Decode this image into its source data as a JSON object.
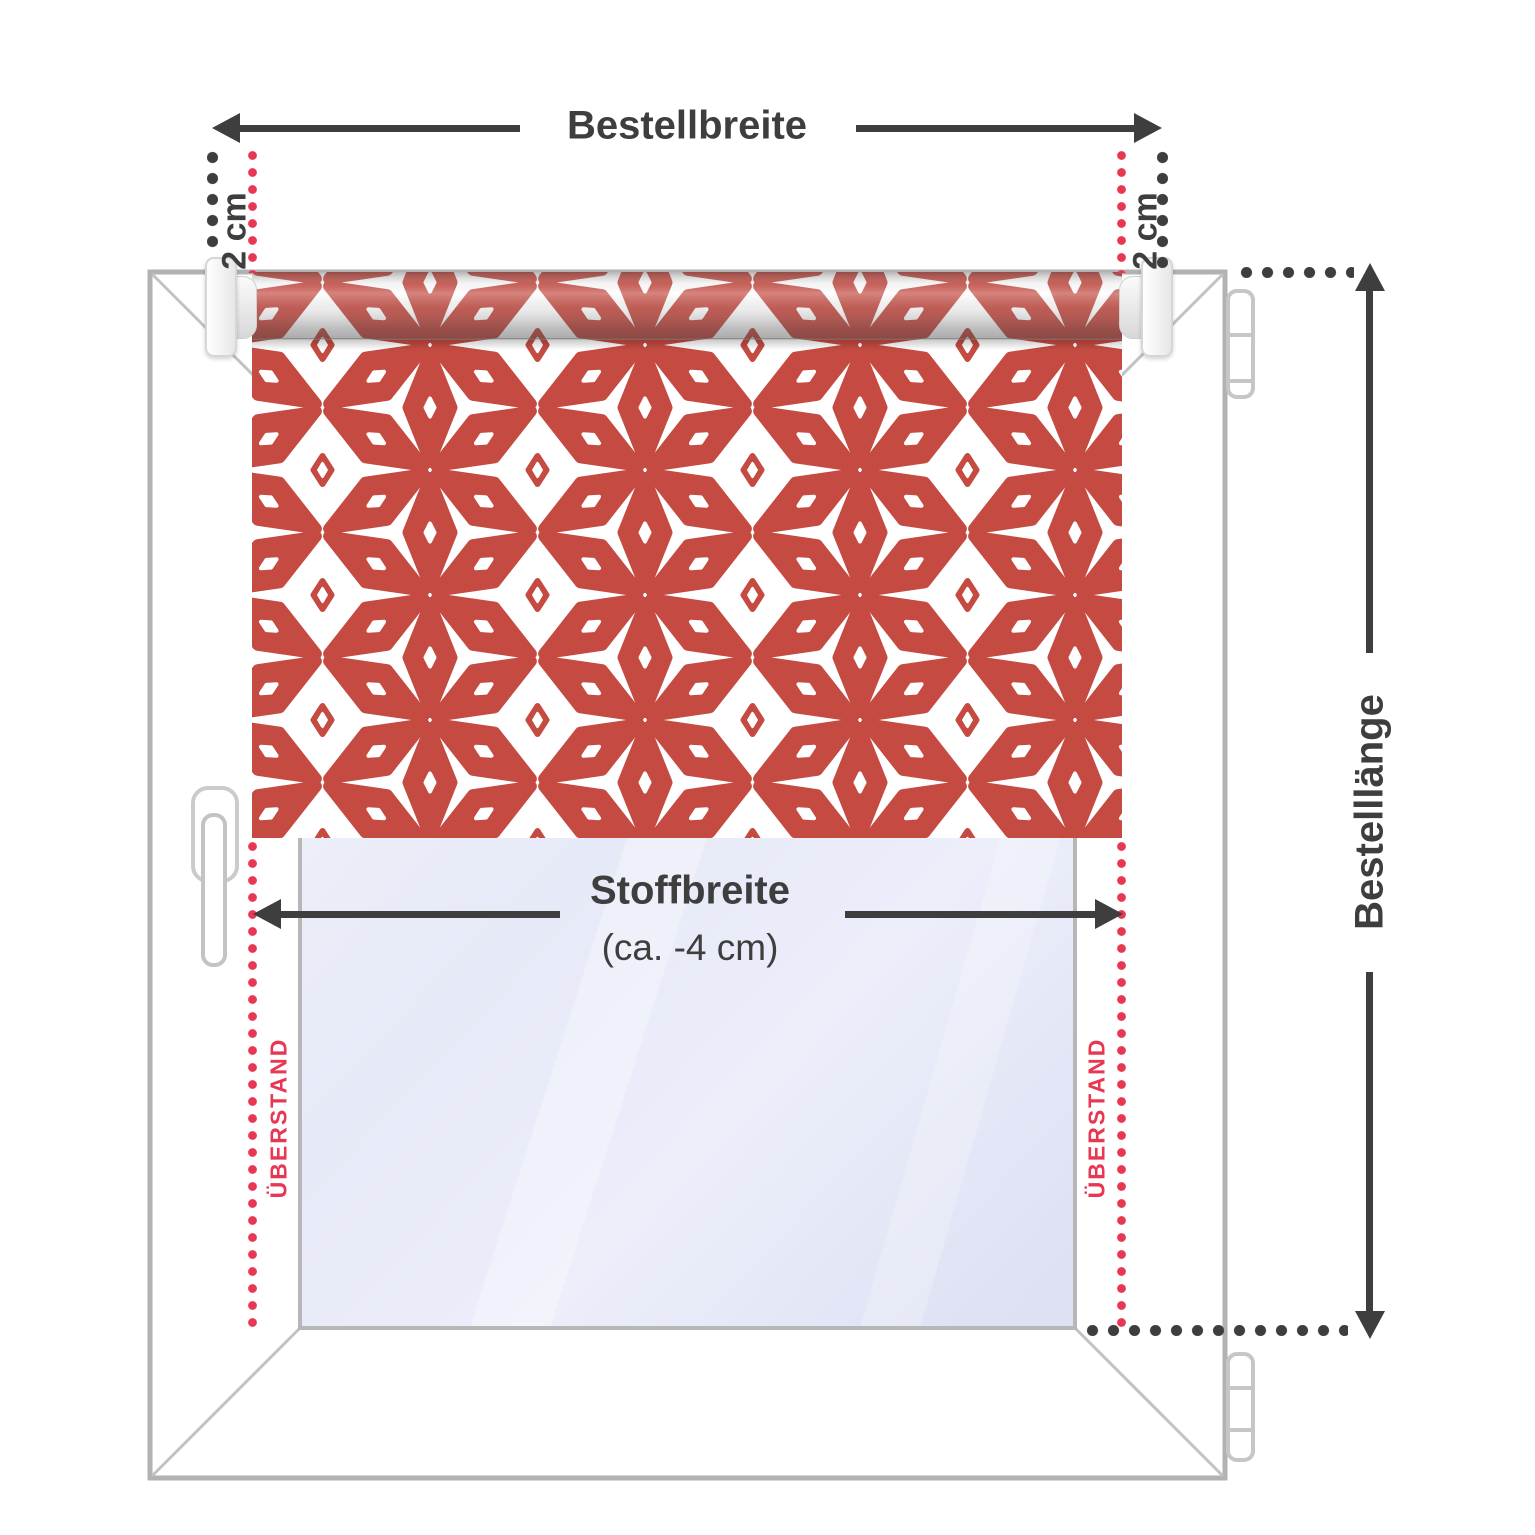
{
  "labels": {
    "order_width": "Bestellbreite",
    "offset_left": "2 cm",
    "offset_right": "2 cm",
    "fabric_width": "Stoffbreite",
    "fabric_width_note": "(ca. -4 cm)",
    "order_length": "Bestelllänge",
    "overhang_left": "ÜBERSTAND",
    "overhang_right": "ÜBERSTAND"
  },
  "colors": {
    "pattern_red": "#c54a41",
    "accent_red": "#e73752",
    "annotation_dark": "#3e3e3e",
    "frame_grey": "#b2b2b2"
  }
}
